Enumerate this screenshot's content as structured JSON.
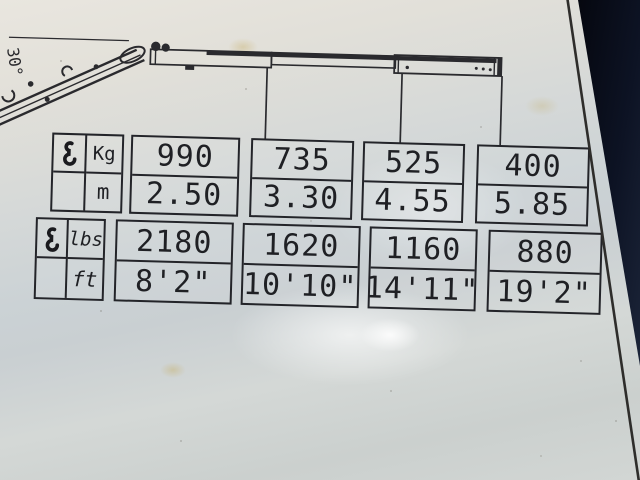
{
  "placard": {
    "angle_label": "30°",
    "metric": {
      "weight_unit": "Kg",
      "distance_unit": "m",
      "columns": [
        {
          "weight": "990",
          "distance": "2.50"
        },
        {
          "weight": "735",
          "distance": "3.30"
        },
        {
          "weight": "525",
          "distance": "4.55"
        },
        {
          "weight": "400",
          "distance": "5.85"
        }
      ]
    },
    "imperial": {
      "weight_unit": "lbs",
      "distance_unit": "ft",
      "columns": [
        {
          "weight": "2180",
          "distance": "8'2\""
        },
        {
          "weight": "1620",
          "distance": "10'10\""
        },
        {
          "weight": "1160",
          "distance": "14'11\""
        },
        {
          "weight": "880",
          "distance": "19'2\""
        }
      ]
    },
    "icons": {
      "header_metric": "crane-hook-icon",
      "header_imperial": "crane-hook-icon"
    },
    "colors": {
      "placard_bg": "#d5d9d7",
      "ink": "#232429",
      "background_dark": "#0c1120"
    }
  }
}
